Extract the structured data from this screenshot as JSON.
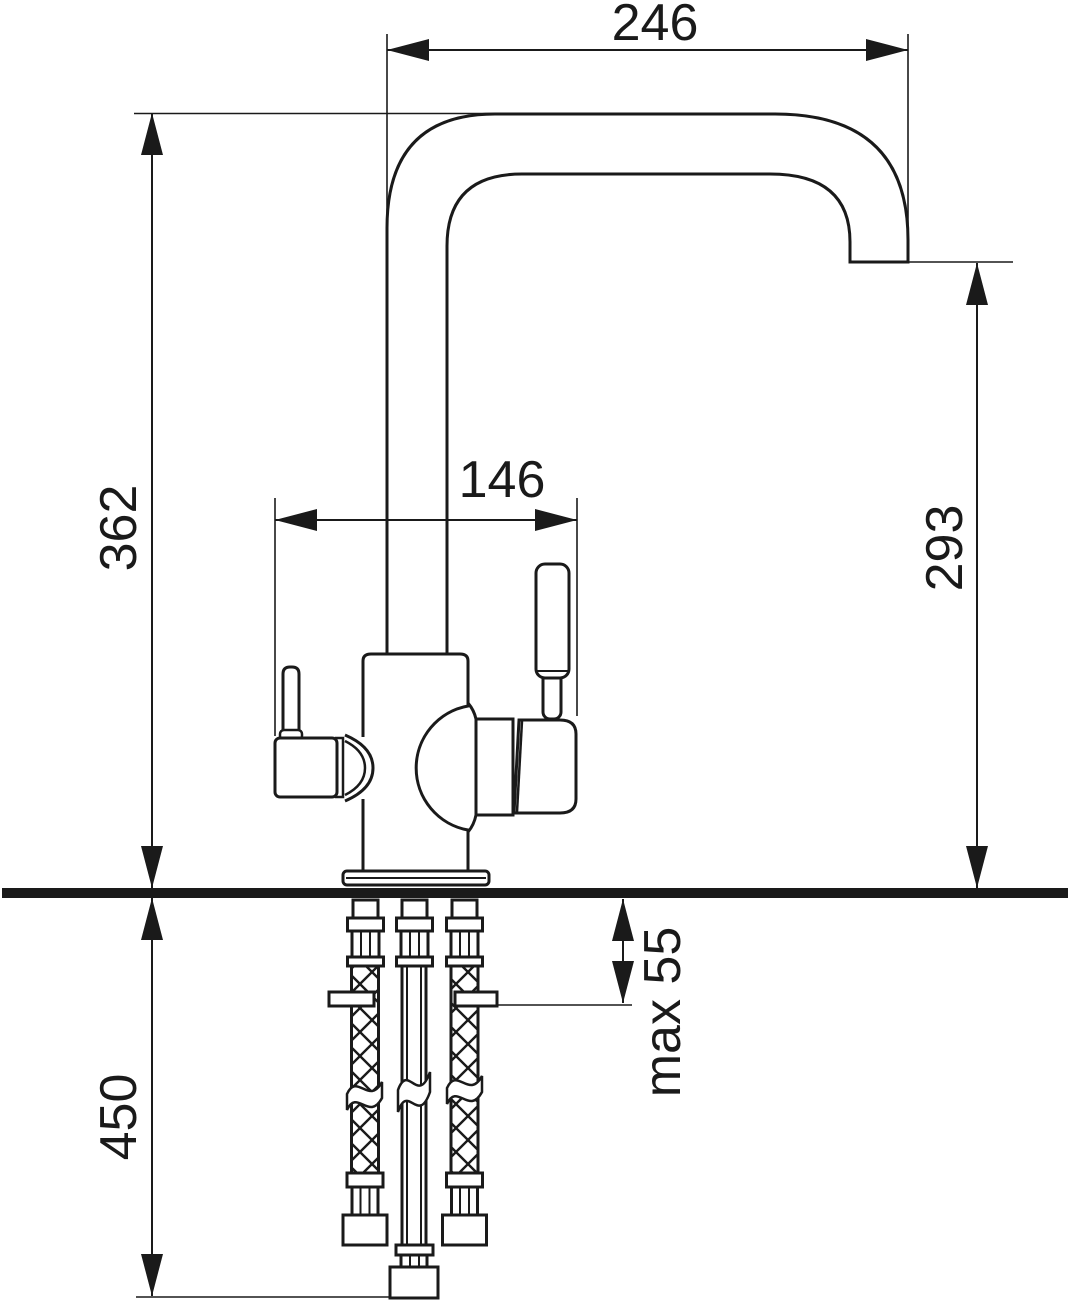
{
  "drawing": {
    "kind": "technical-installation-drawing",
    "subject": "kitchen-mixer-faucet-with-supply-hoses",
    "colors": {
      "line": "#1a1a1a",
      "background": "#ffffff",
      "counter_bar": "#1a1a1a"
    }
  },
  "dimensions": [
    {
      "id": "spout-reach",
      "label": "246",
      "orientation": "horizontal"
    },
    {
      "id": "height-above-counter",
      "label": "362",
      "orientation": "vertical"
    },
    {
      "id": "handle-span",
      "label": "146",
      "orientation": "horizontal"
    },
    {
      "id": "spout-outlet-height",
      "label": "293",
      "orientation": "vertical"
    },
    {
      "id": "hose-length-below-counter",
      "label": "450",
      "orientation": "vertical"
    },
    {
      "id": "max-mounting-thickness",
      "label": "max 55",
      "orientation": "vertical"
    }
  ]
}
